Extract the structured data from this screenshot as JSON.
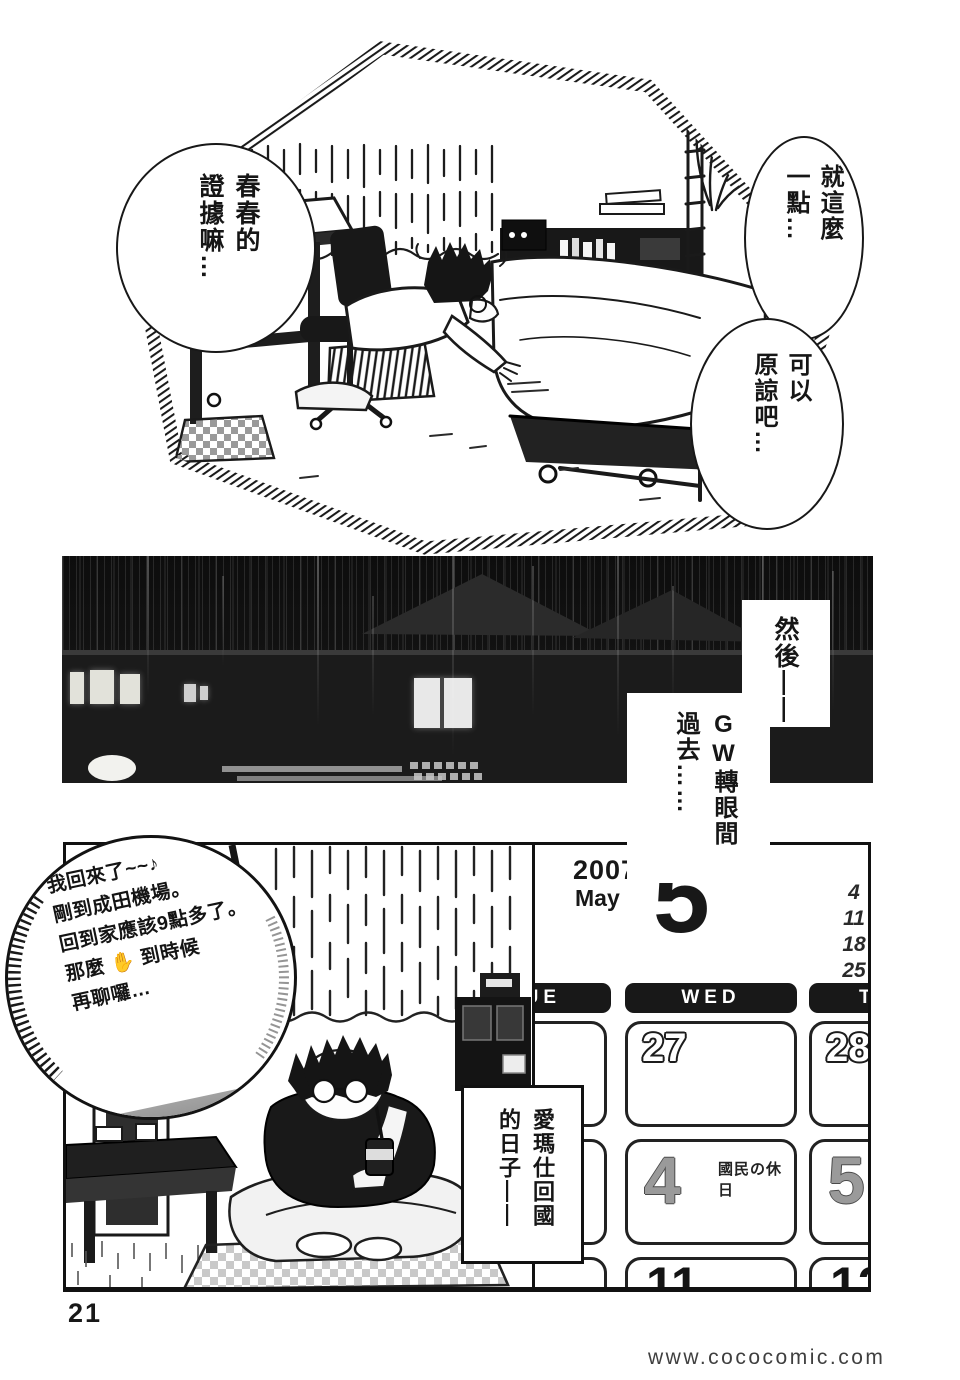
{
  "page": {
    "number": "21",
    "watermark": "www.cococomic.com"
  },
  "colors": {
    "ink": "#181818",
    "paper": "#ffffff",
    "night_sky": "#101010",
    "roof_gray": "#2b2b2b",
    "calendar_day_gray": "#9a9a9a"
  },
  "panel1": {
    "bubbles": [
      {
        "text": "春春的\n證據嘛…"
      },
      {
        "text": "就這麼\n一點…"
      },
      {
        "text": "可以\n原諒吧…"
      }
    ]
  },
  "panel2": {
    "caption_then": "然後——",
    "caption_gw_prefix": "GW",
    "caption_gw_rest": "轉眼間\n過去……"
  },
  "panel3": {
    "phone_lines": [
      "我回來了~~♪",
      "剛到成田機場。",
      "回到家應該9點多了。",
      "那麼 ✋ 到時候",
      "再聊囉…"
    ],
    "caption_return": "愛瑪仕回國\n的日子——",
    "calendar": {
      "year": "2007",
      "month": "May",
      "big_day": "5",
      "side_numbers": [
        "4",
        "11",
        "18",
        "25"
      ],
      "weekday_left": "TUE",
      "weekday_mid": "WED",
      "weekday_right": "THU",
      "row1": [
        "27",
        "28"
      ],
      "row2": [
        "4",
        "5"
      ],
      "holiday_label": "國民の休日",
      "row3": [
        "11",
        "12"
      ]
    }
  }
}
